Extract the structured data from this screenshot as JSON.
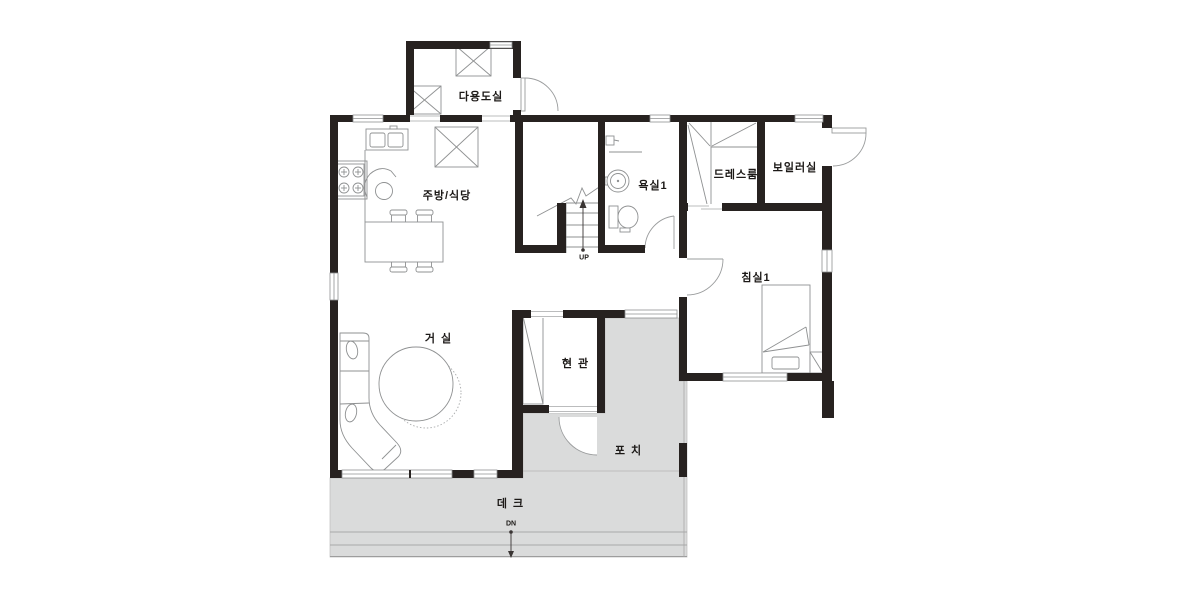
{
  "plan": {
    "rooms": {
      "utility": {
        "label": "다용도실"
      },
      "kitchen": {
        "label": "주방/식당"
      },
      "bathroom1": {
        "label": "욕실1"
      },
      "dressroom": {
        "label": "드레스룸"
      },
      "boiler": {
        "label": "보일러실"
      },
      "bedroom1": {
        "label": "침실1"
      },
      "living": {
        "label": "거실"
      },
      "entrance": {
        "label": "현관"
      },
      "porch": {
        "label": "포치"
      },
      "deck": {
        "label": "데크"
      }
    },
    "annotations": {
      "stairs_up": "UP",
      "deck_down": "DN"
    },
    "colors": {
      "wall": "#272220",
      "paved_floor": "#dadbdb",
      "thin_line": "#8f9192",
      "text": "#1c1917"
    }
  }
}
